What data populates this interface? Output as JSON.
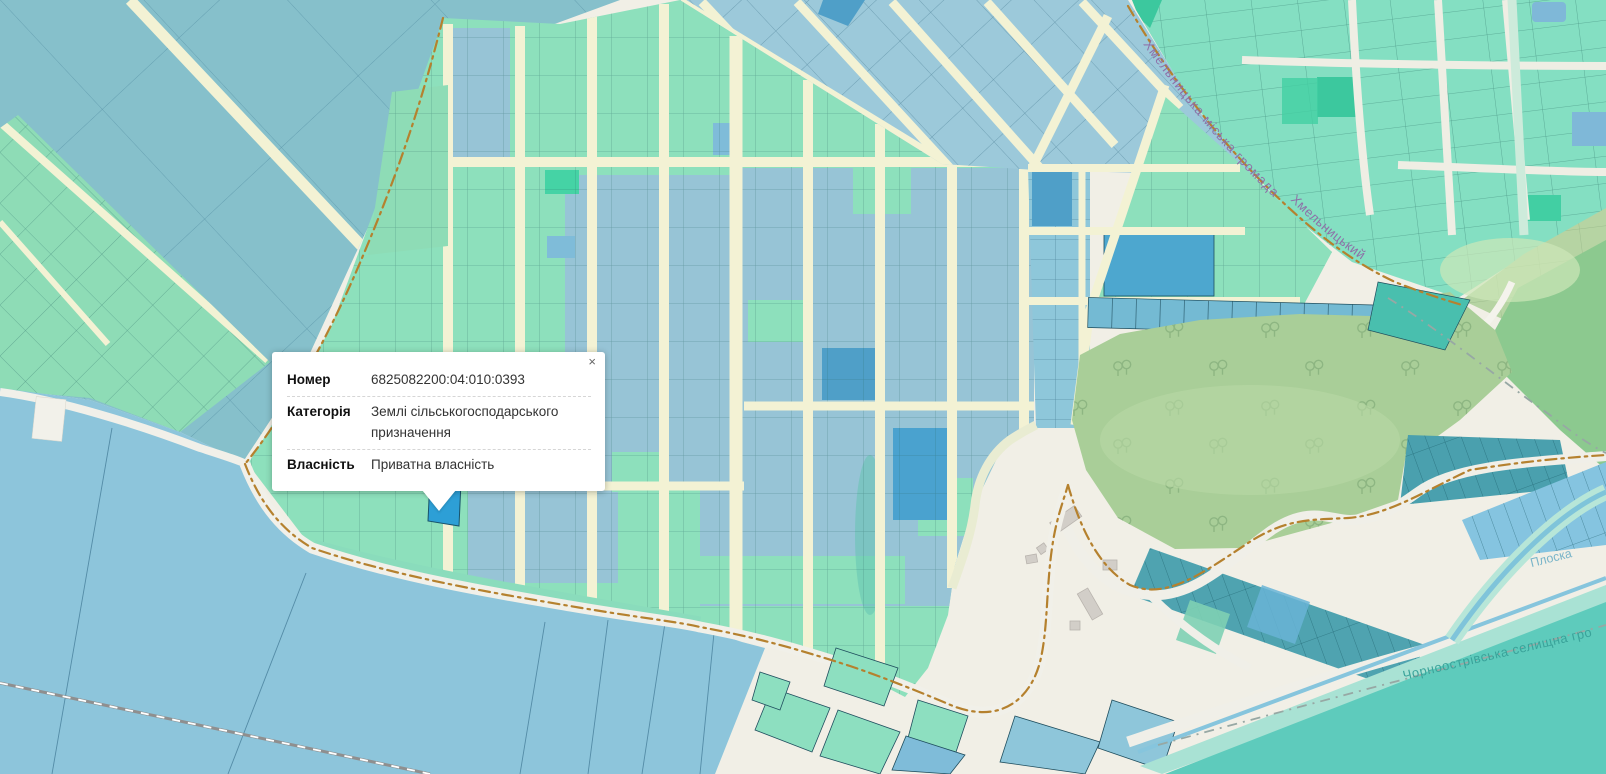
{
  "popup": {
    "close_label": "×",
    "fields": [
      {
        "label": "Номер",
        "value": "6825082200:04:010:0393"
      },
      {
        "label": "Категорія",
        "value": "Землі сільськогосподарського призначення"
      },
      {
        "label": "Власність",
        "value": "Приватна власність"
      }
    ]
  },
  "map_labels": {
    "municipality_upper": "Хмельницька міська громада",
    "road_upper": "Хмельницький",
    "river": "Плоска",
    "municipality_lower": "Чорноострівська селищна гро"
  },
  "colors": {
    "selected_parcel": "#2d9fd6",
    "parcel_green": "#8de0bc",
    "parcel_blue": "#97c4d6",
    "parcel_blue_dark": "#4f9fc8",
    "fields_blue": "#86c0cb",
    "water": "#8dc5db",
    "river_teal": "#5ecbbc",
    "forest_green": "#a9ce98",
    "road_cream": "#f3f2d4",
    "boundary_brown": "#b5812e",
    "label_purple": "#8e6ca6",
    "label_teal": "#3aa39a",
    "label_river": "#7ab5c9"
  }
}
